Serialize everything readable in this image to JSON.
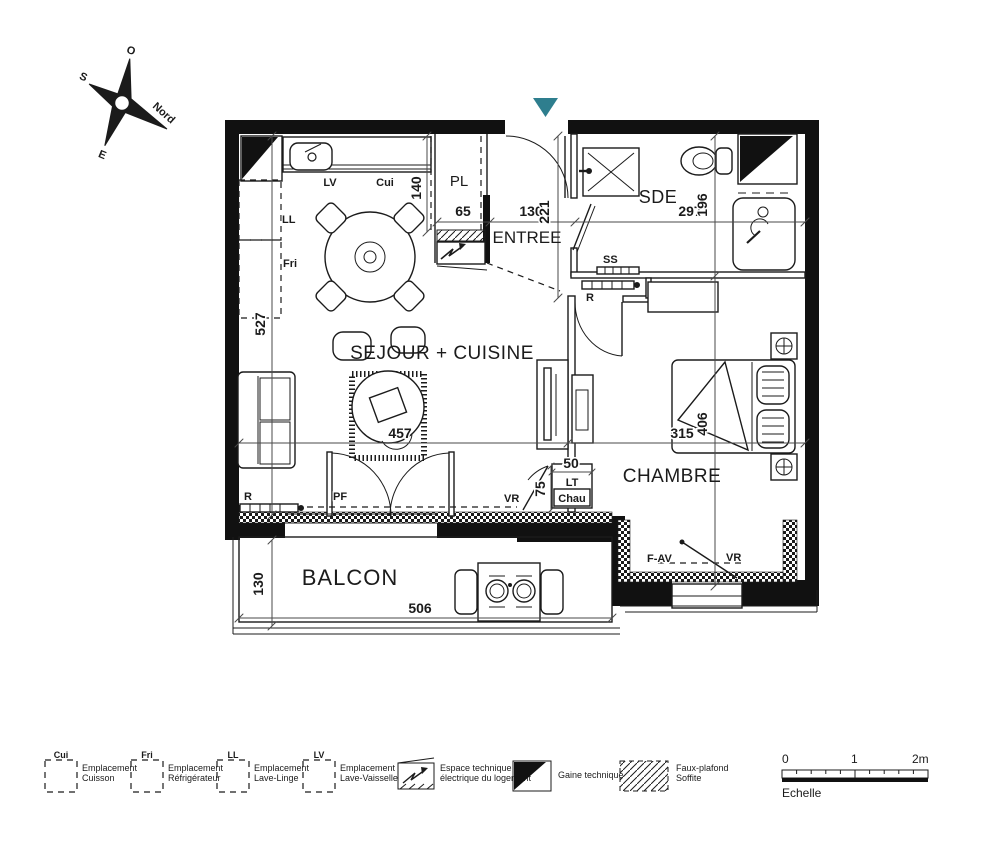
{
  "compass": {
    "o": "O",
    "s": "S",
    "e": "E",
    "nord": "Nord"
  },
  "entrance_marker_color": "#2e7e8e",
  "rooms": {
    "sejour": "SEJOUR + CUISINE",
    "entree": "ENTREE",
    "pl": "PL",
    "sde": "SDE",
    "chambre": "CHAMBRE",
    "balcon": "BALCON"
  },
  "tags": {
    "lv": "LV",
    "cui": "Cui",
    "ll": "LL",
    "fri": "Fri",
    "ss": "SS",
    "r": "R",
    "pf": "PF",
    "vr": "VR",
    "fav": "F-AV",
    "lt": "LT",
    "chau": "Chau"
  },
  "dims": {
    "sejour_height": "527",
    "kitchen_depth": "140",
    "pl_width": "65",
    "entree_width": "130",
    "entree_depth": "221",
    "sde_width": "297",
    "sde_depth": "196",
    "sejour_width": "457",
    "chambre_width": "315",
    "chambre_depth": "406",
    "closet_width": "50",
    "closet_depth": "75",
    "balcon_depth": "130",
    "balcon_width": "506"
  },
  "legend": {
    "items": [
      {
        "code": "Cui",
        "line1": "Emplacement",
        "line2": "Cuisson"
      },
      {
        "code": "Fri",
        "line1": "Emplacement",
        "line2": "Réfrigérateur"
      },
      {
        "code": "LL",
        "line1": "Emplacement",
        "line2": "Lave-Linge"
      },
      {
        "code": "LV",
        "line1": "Emplacement",
        "line2": "Lave-Vaisselle"
      }
    ],
    "espace": {
      "line1": "Espace technique",
      "line2": "électrique du logement"
    },
    "gaine": {
      "label": "Gaine technique"
    },
    "faux": {
      "line1": "Faux-plafond",
      "line2": "Soffite"
    }
  },
  "scale": {
    "tick0": "0",
    "tick1": "1",
    "tick2": "2m",
    "caption": "Echelle"
  }
}
